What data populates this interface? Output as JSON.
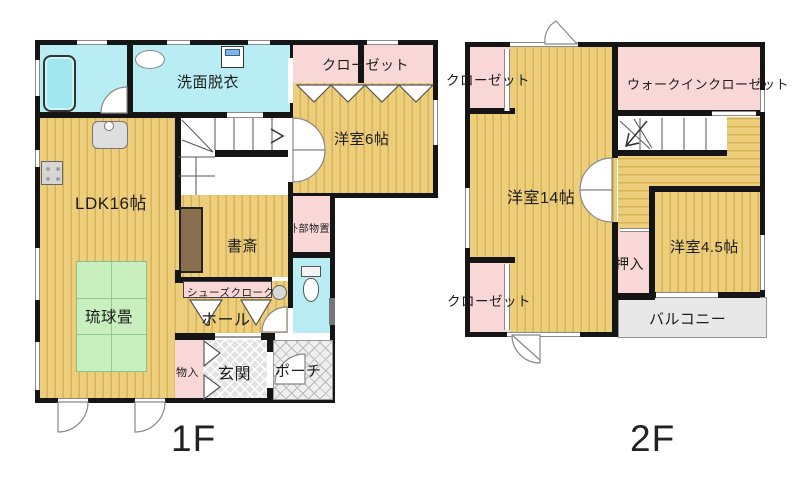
{
  "title": "house-floor-plan",
  "floor1": {
    "floor_label": "1F",
    "labels": {
      "washroom": "洗面脱衣",
      "closet": "クローゼット",
      "western6": "洋室6帖",
      "ldk": "LDK16帖",
      "study": "書斎",
      "ext_storage": "外部物置",
      "ryukyu_tatami": "琉球畳",
      "shoe_cloak": "シューズクローク",
      "hall": "ホール",
      "storage": "物入",
      "entrance": "玄関",
      "porch": "ポーチ"
    }
  },
  "floor2": {
    "floor_label": "2F",
    "labels": {
      "closet_top": "クローゼット",
      "walk_in_closet": "ウォークインクローゼット",
      "western14": "洋室14帖",
      "western45": "洋室4.5帖",
      "oshiire": "押入",
      "closet_bottom": "クローゼット",
      "balcony": "バルコニー"
    }
  },
  "colors": {
    "wall": "#151515",
    "wood_light": "#ecce7c",
    "wood_dark": "#d8b254",
    "closet_pink": "#f9d7d7",
    "water_cyan": "#b7edf3",
    "tatami_green": "#c9efbf",
    "entrance_gray": "#e2e2e2",
    "balcony_gray": "#e8e8e8"
  }
}
